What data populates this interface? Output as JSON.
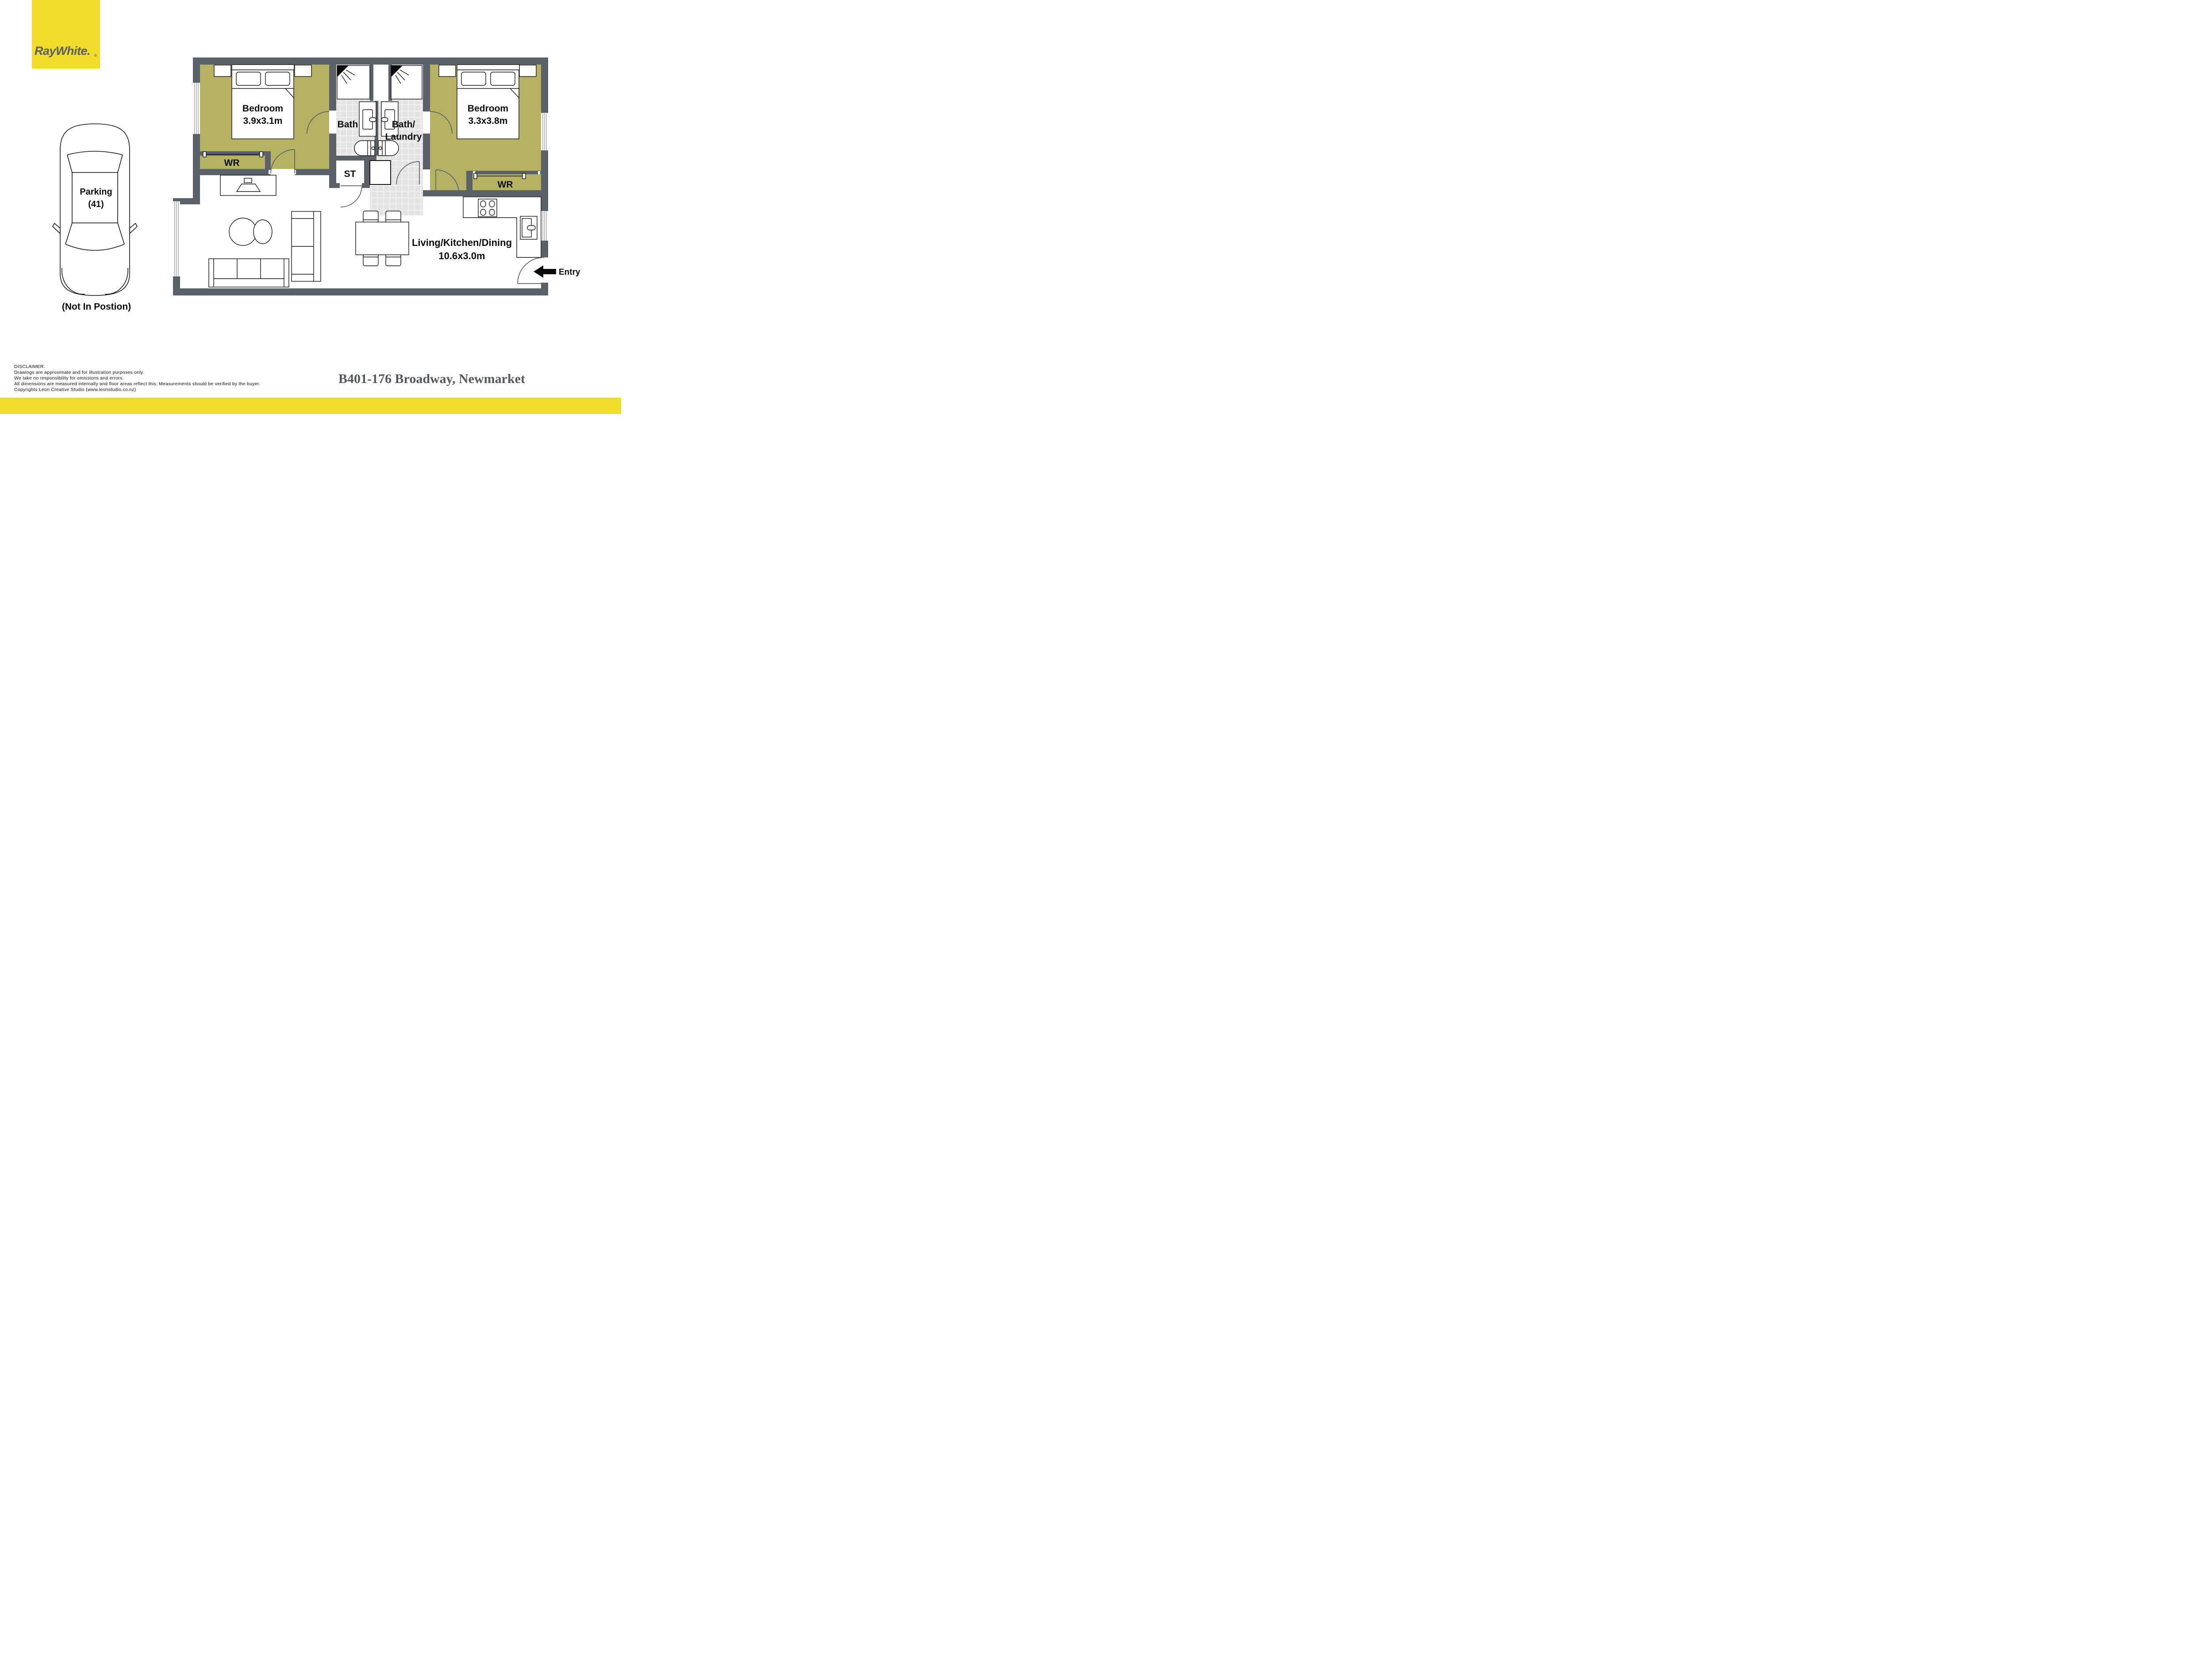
{
  "logo": {
    "brand": "RayWhite.",
    "registered": "®"
  },
  "plan": {
    "bedroom1": {
      "name": "Bedroom",
      "dims": "3.9x3.1m",
      "wr": "WR"
    },
    "bedroom2": {
      "name": "Bedroom",
      "dims": "3.3x3.8m",
      "wr": "WR"
    },
    "bath": {
      "name": "Bath"
    },
    "bath_laundry": {
      "line1": "Bath/",
      "line2": "Laundry"
    },
    "storage": {
      "name": "ST"
    },
    "living": {
      "name": "Living/Kitchen/Dining",
      "dims": "10.6x3.0m"
    },
    "entry": {
      "label": "Entry"
    }
  },
  "parking": {
    "line1": "Parking",
    "line2": "(41)",
    "note": "(Not In Postion)"
  },
  "footer": {
    "disclaimer": [
      "DISCLAIMER:",
      "Drawings are approximate and for illustration purposes only.",
      "We take no responsibility for omissions and errors.",
      "All dimensions are measured internally and floor areas reflect this. Measurements should be verified by the buyer.",
      "Copyrights Leon Creative Studio (www.leonstudio.co.nz)"
    ],
    "address": "B401-176 Broadway, Newmarket"
  },
  "colors": {
    "brand_yellow": "#F1DB2B",
    "wall_gray": "#5A6168",
    "room_olive": "#B5B264",
    "tile_gray": "#E3E3E3",
    "text_dark": "#54575B"
  }
}
